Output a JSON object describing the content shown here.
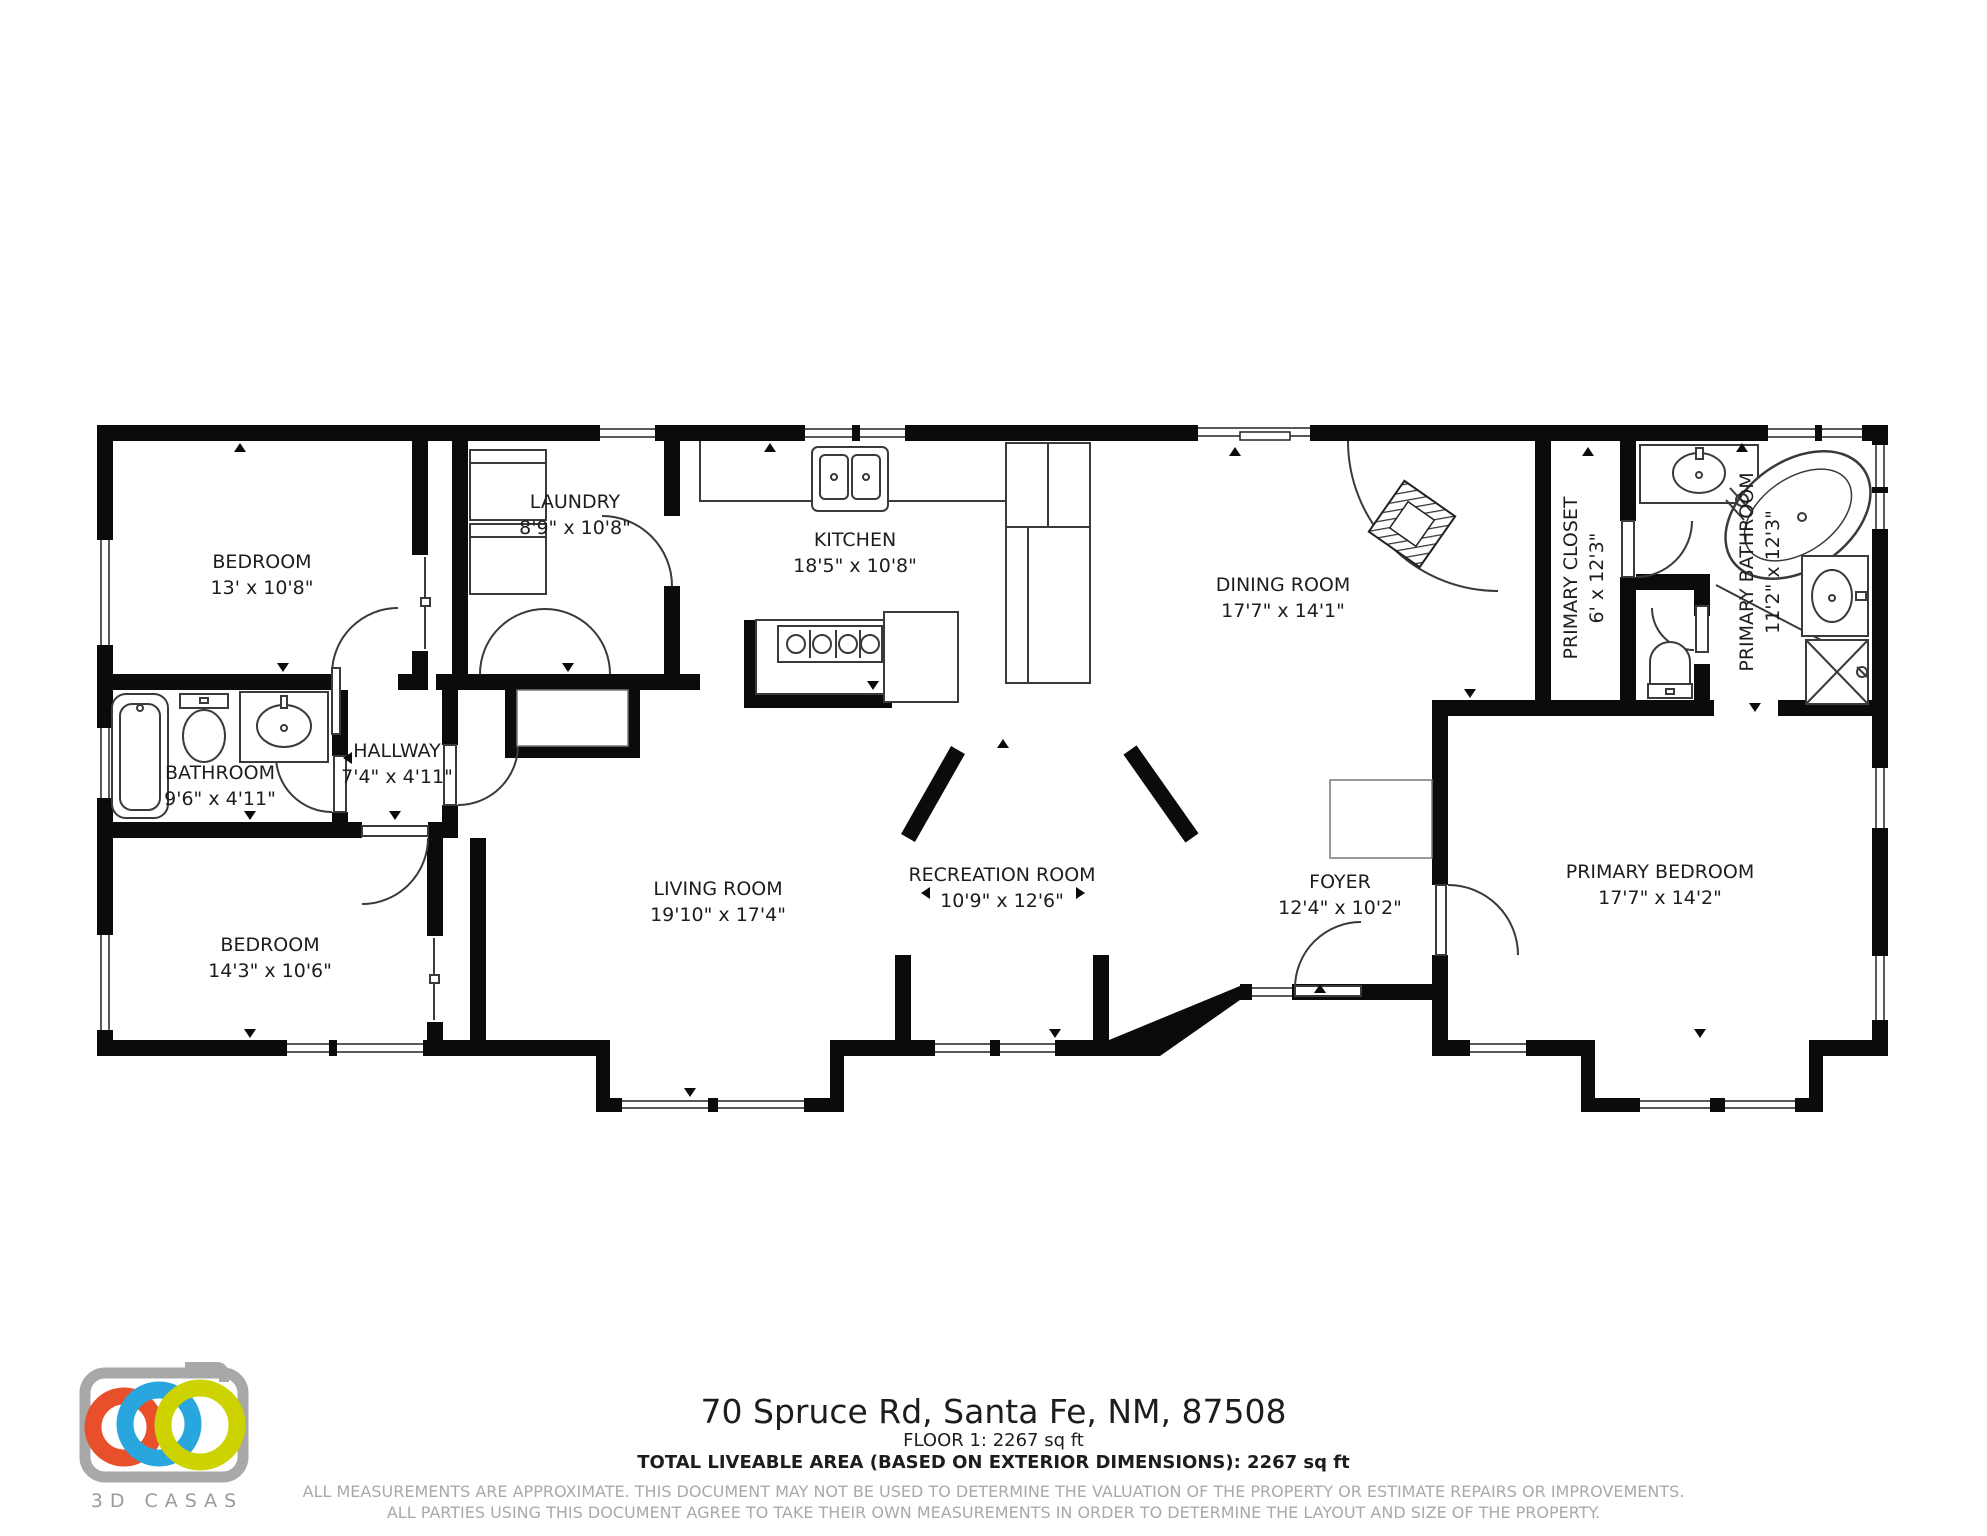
{
  "rooms": [
    {
      "name": "BEDROOM",
      "dims": "13' x 10'8\""
    },
    {
      "name": "LAUNDRY",
      "dims": "8'9\" x 10'8\""
    },
    {
      "name": "KITCHEN",
      "dims": "18'5\" x 10'8\""
    },
    {
      "name": "DINING ROOM",
      "dims": "17'7\" x 14'1\""
    },
    {
      "name": "PRIMARY CLOSET",
      "dims": "6' x 12'3\""
    },
    {
      "name": "PRIMARY BATHROOM",
      "dims": "11'2\" x 12'3\""
    },
    {
      "name": "BATHROOM",
      "dims": "9'6\" x 4'11\""
    },
    {
      "name": "HALLWAY",
      "dims": "7'4\" x 4'11\""
    },
    {
      "name": "BEDROOM",
      "dims": "14'3\" x 10'6\""
    },
    {
      "name": "LIVING ROOM",
      "dims": "19'10\" x 17'4\""
    },
    {
      "name": "RECREATION ROOM",
      "dims": "10'9\" x 12'6\""
    },
    {
      "name": "FOYER",
      "dims": "12'4\" x 10'2\""
    },
    {
      "name": "PRIMARY BEDROOM",
      "dims": "17'7\" x 14'2\""
    }
  ],
  "footer": {
    "address": "70 Spruce Rd, Santa Fe, NM, 87508",
    "floor_line": "FLOOR 1: 2267 sq ft",
    "total_line": "TOTAL LIVEABLE AREA (BASED ON EXTERIOR DIMENSIONS): 2267 sq ft",
    "disclaimer_line1": "ALL MEASUREMENTS ARE APPROXIMATE. THIS DOCUMENT MAY NOT BE USED TO DETERMINE THE VALUATION OF THE PROPERTY OR ESTIMATE REPAIRS OR IMPROVEMENTS.",
    "disclaimer_line2": "ALL PARTIES USING THIS DOCUMENT AGREE TO TAKE THEIR OWN MEASUREMENTS IN ORDER TO DETERMINE THE LAYOUT AND SIZE OF THE PROPERTY."
  },
  "logo": {
    "brand": "3D CASAS",
    "camera_color": "#a8a8a8",
    "ring_colors": {
      "red": "#e8502c",
      "blue": "#2aa6df",
      "yellow": "#ccd300"
    }
  }
}
